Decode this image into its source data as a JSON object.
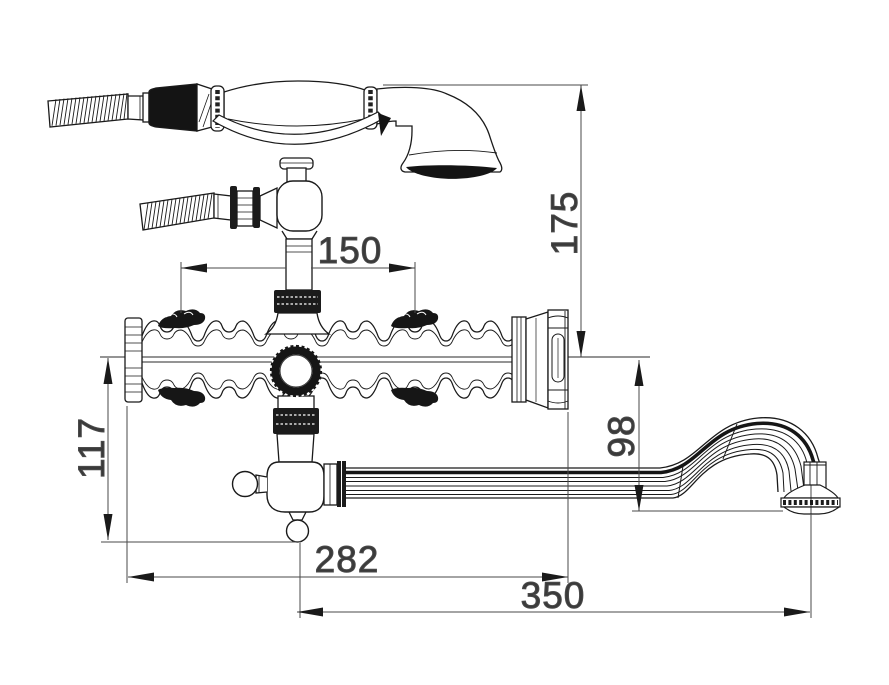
{
  "colors": {
    "background": "#ffffff",
    "line": "#1a1a1a",
    "dimension_line": "#4a4a4a",
    "dimension_text": "#3a3a3a",
    "fill_dark": "#161616"
  },
  "drawing": {
    "type": "technical_drawing",
    "dimensions": {
      "inlet_spacing": {
        "value": "150",
        "orientation": "horizontal"
      },
      "height_top_to_center": {
        "value": "175",
        "orientation": "vertical"
      },
      "center_to_handle": {
        "value": "117",
        "orientation": "vertical"
      },
      "center_to_outlet": {
        "value": "98",
        "orientation": "vertical"
      },
      "body_length": {
        "value": "282",
        "orientation": "horizontal"
      },
      "spout_reach": {
        "value": "350",
        "orientation": "horizontal"
      }
    }
  }
}
